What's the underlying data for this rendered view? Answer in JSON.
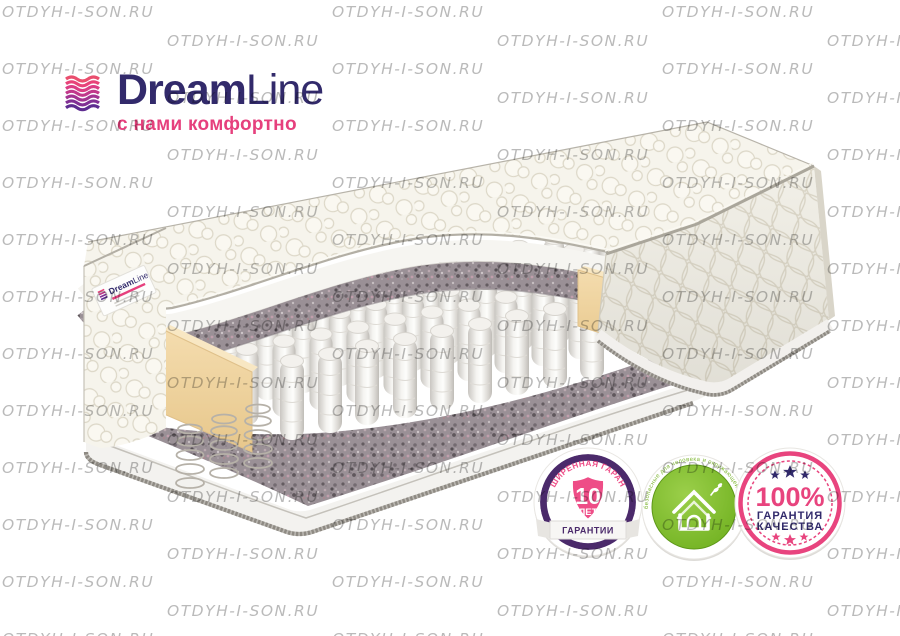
{
  "watermark": {
    "text": "OTDYH-I-SON.RU",
    "color": "#b2b2b2"
  },
  "logo": {
    "brand_bold": "Dream",
    "brand_light": "Line",
    "tagline": "с нами комфортно",
    "brand_color": "#322a6b",
    "tagline_color": "#e6407d",
    "icon_colors": [
      "#ea4e6e",
      "#e84379",
      "#da3d84",
      "#c1388b",
      "#a33491",
      "#813094",
      "#5e2c90"
    ]
  },
  "mattress_label": {
    "brand_bold": "Dream",
    "brand_light": "Line"
  },
  "badges": {
    "warranty": {
      "arc_text": "РАСШИРЕННАЯ ГАРАНТИЯ",
      "years": "10",
      "unit": "ЛЕТ",
      "ribbon_text": "ГАРАНТИИ",
      "ring_color": "#4b2a6b",
      "accent_color": "#ee4d87"
    },
    "eco": {
      "arc_text": "безопасные для человека и окружающей среды",
      "green_color": "#76b82d"
    },
    "quality": {
      "percent": "100%",
      "line1": "ГАРАНТИЯ",
      "line2": "КАЧЕСТВА",
      "accent_color": "#e8447e",
      "navy_color": "#312a6b"
    }
  }
}
